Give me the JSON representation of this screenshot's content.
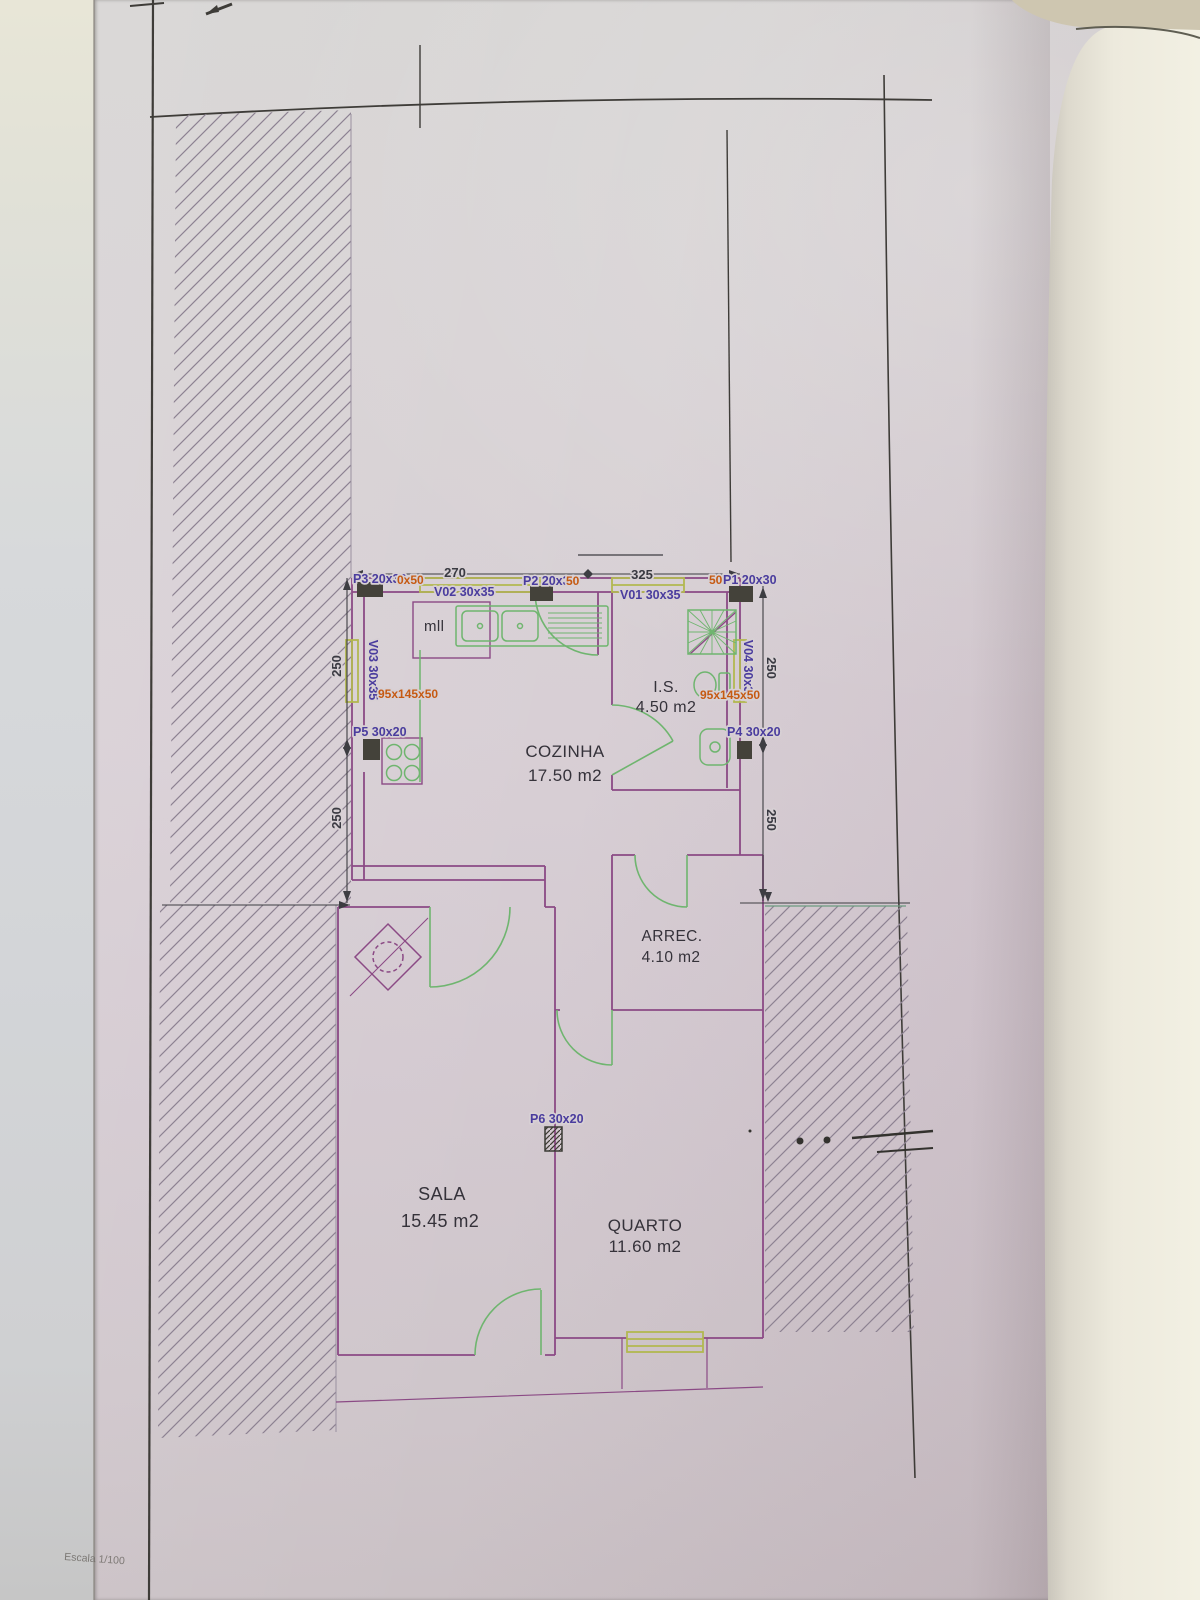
{
  "photo": {
    "description": "Photographed architectural floor plan sheet",
    "scale_label": "Escala 1/100"
  },
  "rooms": {
    "cozinha": {
      "name": "COZINHA",
      "area": "17.50 m2"
    },
    "is": {
      "name": "I.S.",
      "area": "4.50 m2"
    },
    "arrec": {
      "name": "ARREC.",
      "area": "4.10 m2"
    },
    "sala": {
      "name": "SALA",
      "area": "15.45 m2"
    },
    "quarto": {
      "name": "QUARTO",
      "area": "11.60 m2"
    }
  },
  "openings": {
    "p1": "P1 20x30",
    "p1_extra": "50",
    "p2": "P2 20x30",
    "p2_extra": "50",
    "p3": "P3 20x30",
    "p3_extra": "0x50",
    "p4": "P4 30x20",
    "p5": "P5 30x20",
    "p6": "P6 30x20",
    "v01": "V01 30x35",
    "v02": "V02 30x35",
    "v03": "V03 30x35",
    "v04": "V04 30x35",
    "counter_left": "95x145x50",
    "counter_right": "95x145x50"
  },
  "dimensions": {
    "top_left": "270",
    "top_right": "325",
    "side": "250"
  },
  "notes": {
    "kitchen": "mll"
  },
  "colors": {
    "walls": "#8b4a85",
    "fixtures": "#6fb56f",
    "windows": "#b2b850",
    "label_blue": "#4a3c9e",
    "label_orange": "#c65a12",
    "frame": "#3e3c38",
    "text_dark": "#35323a"
  }
}
